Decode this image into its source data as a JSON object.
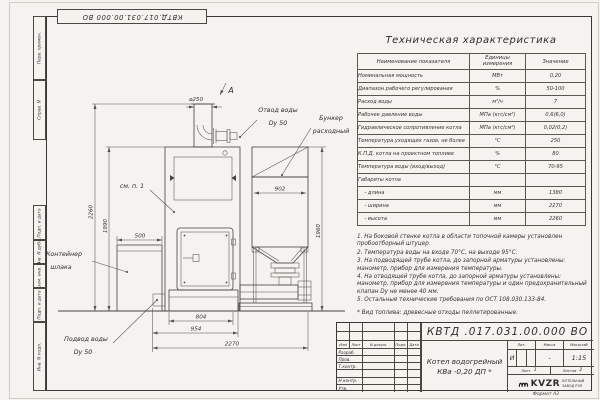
{
  "doc": {
    "code_top": "КВТД.017.031.00.000  ВО",
    "format": "Формат А3"
  },
  "frame": {
    "left_labels": [
      "Перв. примен.",
      "Справ. N",
      "Подп. и дата",
      "Инв. N дубл.",
      "Взам. инв. N",
      "Подп. и дата",
      "Инв. N подл."
    ]
  },
  "table": {
    "title": "Техническая характеристика",
    "headers": [
      "Наименование показателя",
      "Единицы измерения",
      "Значение"
    ],
    "rows": [
      {
        "name": "Номинальная мощность",
        "unit": "МВт",
        "value": "0,20"
      },
      {
        "name": "Диапазон рабочего регулирования",
        "unit": "%",
        "value": "50-100"
      },
      {
        "name": "Расход воды",
        "unit": "м³/ч",
        "value": "7"
      },
      {
        "name": "Рабочее давление воды",
        "unit": "МПа (кгс/см²)",
        "value": "0,6(6,0)"
      },
      {
        "name": "Гидравлическое сопротивление котла",
        "unit": "МПа (кгс/см²)",
        "value": "0,02(0,2)"
      },
      {
        "name": "Температура уходящих газов, не более",
        "unit": "°С",
        "value": "250"
      },
      {
        "name": "К.П.Д. котла на проектном топливе",
        "unit": "%",
        "value": "80"
      },
      {
        "name": "Температура воды (вход/выход)",
        "unit": "°С",
        "value": "70-95"
      },
      {
        "name": "Габариты котла",
        "unit": "",
        "value": ""
      },
      {
        "name": "    - длина",
        "unit": "мм",
        "value": "1380"
      },
      {
        "name": "    - ширина",
        "unit": "мм",
        "value": "2270"
      },
      {
        "name": "    - высота",
        "unit": "мм",
        "value": "2260"
      }
    ]
  },
  "notes": [
    "1. На боковой стенке котла в области топочной камеры установлен пробоотборный штуцер.",
    "2. Температура воды на входе 70°С, на выходе 95°С.",
    "3. На подводящей трубе котла, до запорной арматуры установлены: манометр, прибор для измерения температуры.",
    "4. На отводящей трубе котла, до запорной арматуры установлены: манометр, прибор для измерения температуры и один предохранительный клапан Dу не менее 40 мм.",
    "5. Остальные технические требования по ОСТ 108.030.133-84."
  ],
  "fuel_note": "* Вид топлива: древесные отходы пеллетированные.",
  "title_block": {
    "code": "КВТД .017.031.00.000  ВО",
    "cols": [
      "Изм",
      "Лист",
      "N докум.",
      "Подп.",
      "Дата"
    ],
    "roles": [
      "Разраб.",
      "Пров.",
      "Т.контр.",
      "",
      "Н.контр.",
      "Утв."
    ],
    "product_line1": "Котел водогрейный",
    "product_line2": "КВа -0,20  ДП *",
    "lit_header": "Лит.",
    "mass_header": "Масса",
    "scale_header": "Масштаб",
    "lit": "И",
    "mass": "-",
    "scale": "1:15",
    "sheet_label": "Лист",
    "sheet_value": "1",
    "sheets_label": "Листов",
    "sheets_value": "2",
    "brand": "KVZR",
    "brand_line1": "КОТЕЛЬНЫЙ",
    "brand_line2": "ЗАВОД РЭП"
  },
  "drawing": {
    "view_label": "А",
    "dims": {
      "d250": "⌀250",
      "w500": "500",
      "w804": "804",
      "w954": "954",
      "w2270": "2270",
      "w902": "902",
      "h1960": "1960",
      "h1990": "1990",
      "h2260": "2260"
    },
    "labels": {
      "otvod1": "Отвод воды",
      "otvod2": "Dy 50",
      "bunker1": "Бункер",
      "bunker2": "расходный",
      "container1": "Контейнер",
      "container2": "шлака",
      "podvod1": "Подвод воды",
      "podvod2": "Dy 50",
      "see_note": "см. п. 1"
    }
  }
}
